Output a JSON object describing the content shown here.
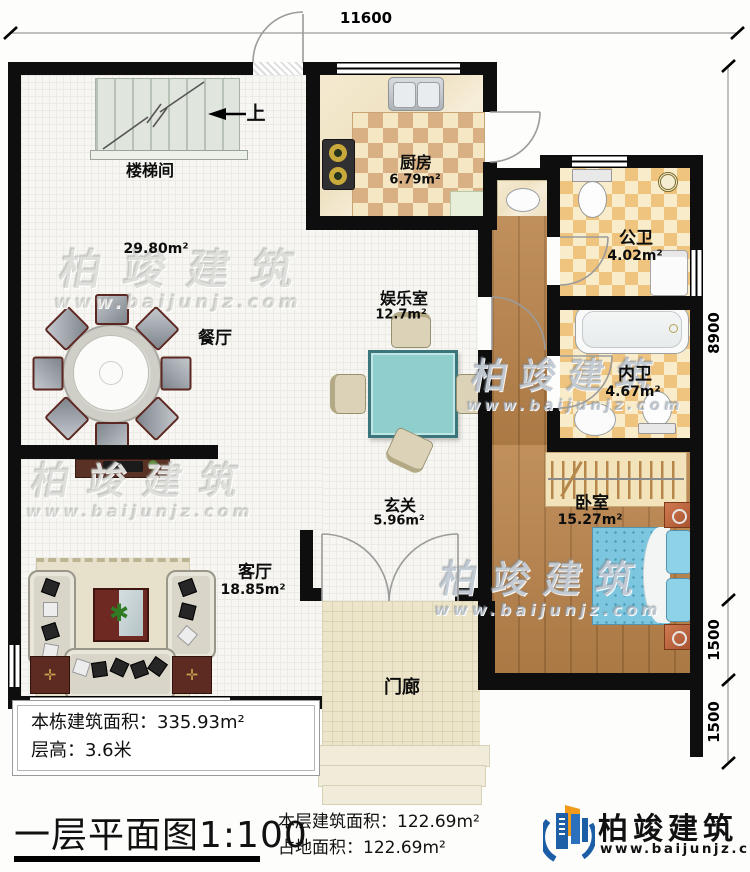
{
  "plan_title": "一层平面图1:100",
  "dimensions": {
    "top": "11600",
    "right_upper": "8900",
    "right_middle": "1500",
    "right_lower": "1500"
  },
  "stairs": {
    "direction": "上"
  },
  "rooms": {
    "stairwell": {
      "label": "楼梯间"
    },
    "dining": {
      "label": "餐厅",
      "area": "29.80m²"
    },
    "kitchen": {
      "label": "厨房",
      "area": "6.79m²"
    },
    "entertainment": {
      "label": "娱乐室",
      "area": "12.7m²"
    },
    "public_bath": {
      "label": "公卫",
      "area": "4.02m²"
    },
    "private_bath": {
      "label": "内卫",
      "area": "4.67m²"
    },
    "bedroom": {
      "label": "卧室",
      "area": "15.27m²"
    },
    "foyer": {
      "label": "玄关",
      "area": "5.96m²"
    },
    "living": {
      "label": "客厅",
      "area": "18.85m²"
    },
    "porch": {
      "label": "门廊"
    }
  },
  "info_box": {
    "building_area": "本栋建筑面积：335.93m²",
    "floor_height": "层高：3.6米"
  },
  "floor_stats": {
    "floor_area": "本层建筑面积：122.69m²",
    "footprint": "占地面积：122.69m²"
  },
  "logo": {
    "name": "柏竣建筑",
    "website": "www.baijunjz.com"
  },
  "watermark": {
    "name": "柏竣建筑",
    "website": "www.baijunjz.com"
  },
  "colors": {
    "wall": "#0e0e0e",
    "wood_floor": "#b9834a",
    "kitchen_check": "#d8b083",
    "bath_check": "#eec47e",
    "bed_blue": "#7cc6df",
    "table_teal": "#8ecfce",
    "logo_blue": "#1b5ea6",
    "logo_orange": "#f29a1b"
  }
}
